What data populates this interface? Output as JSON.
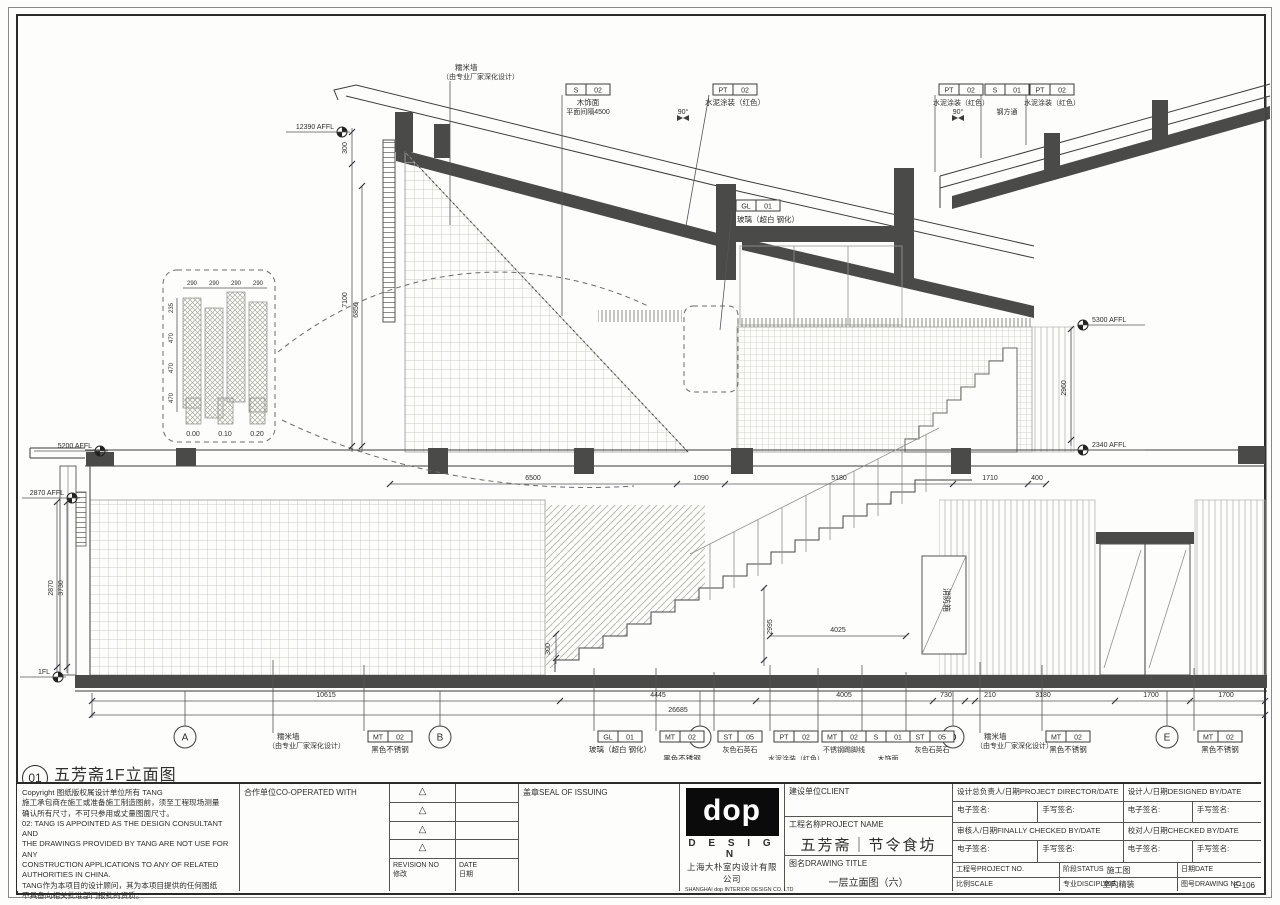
{
  "drawing": {
    "view": {
      "num": "01",
      "title": "五芳斋1F立面图",
      "scale": "Scale:1:50"
    },
    "tags": {
      "s02": {
        "c": "S",
        "n": "02",
        "d": "木饰面",
        "d2": "平面间隔4500"
      },
      "s01steel": {
        "c": "S",
        "n": "01",
        "d": "钢方通"
      },
      "s01wood": {
        "c": "S",
        "n": "01",
        "d": "木饰面"
      },
      "pt02": {
        "c": "PT",
        "n": "02",
        "d": "水泥涂装（红色）"
      },
      "gl01": {
        "c": "GL",
        "n": "01",
        "d": "玻璃（超白 钢化）"
      },
      "mt02": {
        "c": "MT",
        "n": "02",
        "d": "黑色不锈钢"
      },
      "mt02skirt": {
        "c": "MT",
        "n": "02",
        "d": "不锈钢踢脚线"
      },
      "st05": {
        "c": "ST",
        "n": "05",
        "d": "灰色石英石"
      }
    },
    "notes": {
      "nuomi1": "糯米墙",
      "nuomi2": "（由专业厂家深化设计）",
      "deg90": "90°",
      "fire": "消防箱"
    },
    "levels": {
      "top": "12390 AFFL",
      "mid_hi": "5200 AFFL",
      "mid_lo": "2870 AFFL",
      "ground": "1FL",
      "right_hi": "5300 AFFL",
      "right_lo": "2340 AFFL"
    },
    "vdims": {
      "a": "300",
      "b": "7100",
      "c": "6850",
      "d": "2870",
      "e": "3730",
      "f": "2960",
      "g": "2995",
      "h": "300"
    },
    "sdims": {
      "a": "4025"
    },
    "dims_mid": [
      "6500",
      "1090",
      "5180",
      "1710",
      "400"
    ],
    "dims_bottom": [
      "10615",
      "4445",
      "4005",
      "730",
      "210",
      "3180",
      "1700",
      "1700"
    ],
    "dim_total": "26685",
    "grids": [
      "A",
      "B",
      "C",
      "D",
      "E"
    ],
    "detail": {
      "top": [
        "290",
        "290",
        "290",
        "290"
      ],
      "side": [
        "235",
        "470",
        "470",
        "470"
      ],
      "legend": [
        "0.00",
        "0.10",
        "0.20"
      ]
    }
  },
  "titleblock": {
    "copyright": {
      "lines": [
        "Copyright 图纸版权属设计单位所有 TANG",
        "施工承包商在施工或准备施工制造图前，须至工程现场测量",
        "确认所有尺寸，不可只参用或丈量图面尺寸。",
        "02: TANG IS APPOINTED AS THE DESIGN CONSULTANT AND",
        "THE DRAWINGS PROVIDED BY TANG ARE NOT USE FOR ANY",
        "CONSTRUCTION APPLICATIONS TO ANY OF RELATED",
        "AUTHORITIES IN CHINA.",
        "TANG作为本项目的设计顾问，其为本项目提供的任何图纸",
        "不具备向相关批准部门报批的资质。"
      ]
    },
    "coop_label": "合作单位CO-OPERATED WITH",
    "seal_label": "盖章SEAL OF ISSUING",
    "revision": {
      "mark": "△",
      "en_no": "REVISION NO",
      "en_date": "DATE",
      "cn_no": "修改",
      "cn_date": "日期"
    },
    "logo": {
      "wordmark": "dop",
      "design": "D E S I G N",
      "cn": "上海大朴室内设计有限公司",
      "en": "SHANGHAI dop INTERIOR DESIGN CO. LTD"
    },
    "client_label": "建设单位CLIENT",
    "project_label": "工程名称PROJECT NAME",
    "project_name": "五芳斋｜节令食坊",
    "title_label": "图名DRAWING TITLE",
    "title_value": "一层立面图（六）",
    "director_label": "设计总负责人/日期PROJECT DIRECTOR/DATE",
    "designed_label": "设计人/日期DESIGNED BY/DATE",
    "checked_final_label": "审核人/日期FINALLY CHECKED BY/DATE",
    "checked_label": "校对人/日期CHECKED BY/DATE",
    "esign": "电子签名:",
    "hsign": "手写签名:",
    "project_no_label": "工程号PROJECT NO.",
    "status_label": "阶段STATUS",
    "status_value": "施工图",
    "date_label": "日期DATE",
    "scale_label": "比例SCALE",
    "discipline_label": "专业DISCIPLINE",
    "discipline_value": "室内精装",
    "no_label": "图号DRAWING NO.",
    "no_value": "E-106"
  }
}
